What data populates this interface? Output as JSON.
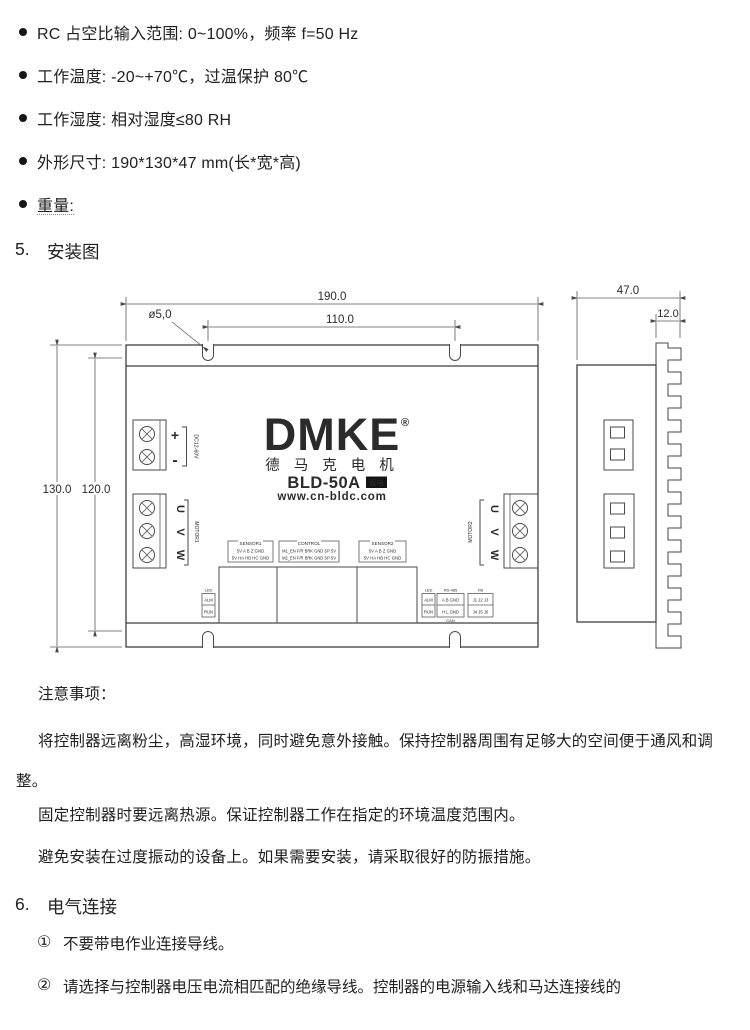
{
  "page": {
    "specs": [
      "RC 占空比输入范围: 0~100%，频率 f=50 Hz",
      "工作温度: -20~+70℃，过温保护 80℃",
      "工作湿度: 相对湿度≤80 RH",
      "外形尺寸: 190*130*47 mm(长*宽*高)",
      "重量:"
    ],
    "section5": {
      "number": "5.",
      "title": "安装图"
    },
    "notes_title": "注意事项：",
    "notes": [
      "将控制器远离粉尘，高湿环境，同时避免意外接触。保持控制器周围有足够大的空间便于通风和调整。",
      "固定控制器时要远离热源。保证控制器工作在指定的环境温度范围内。",
      "避免安装在过度振动的设备上。如果需要安装，请采取很好的防振措施。"
    ],
    "section6": {
      "number": "6.",
      "title": "电气连接"
    },
    "items": [
      {
        "marker": "①",
        "text": "不要带电作业连接导线。"
      },
      {
        "marker": "②",
        "text": "请选择与控制器电压电流相匹配的绝缘导线。控制器的电源输入线和马达连接线的"
      }
    ]
  },
  "diagram": {
    "dims": {
      "width": "190.0",
      "slot_span": "110.0",
      "hole": "ø5,0",
      "height": "130.0",
      "inner_height": "120.0",
      "depth": "47.0",
      "fin": "12.0"
    },
    "logo": {
      "brand": "DMKE",
      "reg": "®",
      "cn": "德 马 克 电 机",
      "model": "BLD-50A",
      "badge": "双电",
      "site": "www.cn-bldc.com"
    },
    "power": {
      "plus": "+",
      "minus": "-",
      "range": "DC12-60V"
    },
    "motor1": {
      "label": "MOTOR1",
      "pins": [
        "U",
        "V",
        "W"
      ]
    },
    "motor2": {
      "label": "MOTOR2",
      "pins": [
        "U",
        "V",
        "W"
      ]
    },
    "sensor1": {
      "title": "SENSOR1",
      "row1": "5V A B Z GND",
      "row2": "5V HA HB HC GND"
    },
    "control": {
      "title": "CONTROL",
      "row1": "M1_EN F/R BRK GND SP 5V",
      "row2": "M2_EN F/R BRK GND SP 5V"
    },
    "sensor2": {
      "title": "SENSOR2",
      "row1": "5V A B Z GND",
      "row2": "5V HA HB HC GND"
    },
    "led": {
      "title": "LED",
      "alarm": "ALM",
      "run": "RUN"
    },
    "rs485": {
      "title": "RS-485",
      "row1": "A B GND",
      "row2": "H L GND",
      "footer": "CAN"
    },
    "jumper": {
      "title": "FB",
      "row1": "J1 J2 J3",
      "row2": "J4 J5 J6"
    }
  }
}
